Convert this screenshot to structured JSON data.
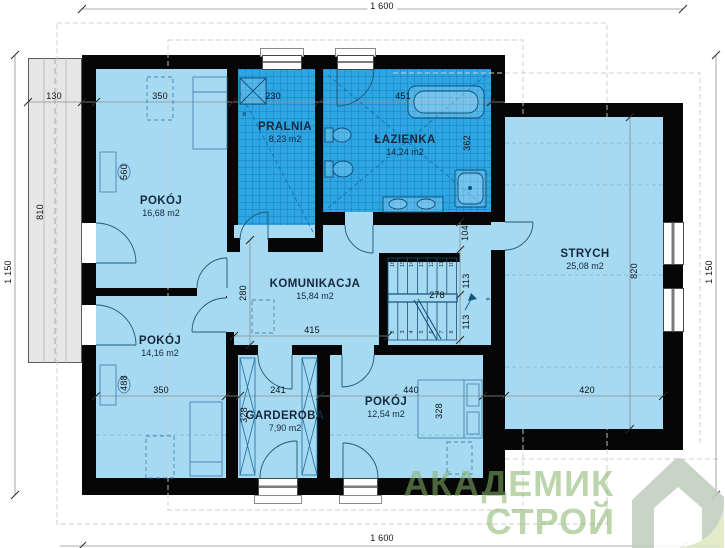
{
  "plan": {
    "title_note": "attic floor plan",
    "rooms": {
      "pokoj1": {
        "name": "POKÓJ",
        "area": "16,68 m2"
      },
      "pralnia": {
        "name": "PRALNIA",
        "area": "8,23 m2"
      },
      "lazienka": {
        "name": "ŁAZIENKA",
        "area": "14,24 m2"
      },
      "strych": {
        "name": "STRYCH",
        "area": "25,08 m2"
      },
      "komunikacja": {
        "name": "KOMUNIKACJA",
        "area": "15,84 m2"
      },
      "pokoj2": {
        "name": "POKÓJ",
        "area": "14,16 m2"
      },
      "garderoba": {
        "name": "GARDEROBA",
        "area": "7,90 m2"
      },
      "pokoj3": {
        "name": "POKÓJ",
        "area": "12,54 m2"
      }
    },
    "dimensions": {
      "overall_top": "1 600",
      "overall_bottom": "1 600",
      "overall_left": "1 150",
      "overall_right": "1 150",
      "balcony_width": "130",
      "balcony_length": "810",
      "pokoj1_width": "350",
      "pokoj1_depth": "560",
      "pralnia_width": "230",
      "lazienka_width": "451",
      "lazienka_depth": "362",
      "strych_depth": "820",
      "strych_width": "420",
      "komunikacja_depth": "280",
      "komunikacja_width": "415",
      "strych_door_width": "104",
      "stairs_width": "278",
      "stairs_run_upper": "113",
      "stairs_run_lower": "113",
      "pokoj2_depth": "488",
      "pokoj2_width": "350",
      "garderoba_width": "241",
      "garderoba_depth": "328",
      "pokoj3_width": "440",
      "pokoj3_depth": "328"
    },
    "stairs": {
      "top_treads": [
        "16",
        "15",
        "14",
        "13",
        "12",
        "11",
        "10"
      ],
      "bottom_treads": [
        "2",
        "3",
        "4",
        "5",
        "6",
        "7",
        "8"
      ],
      "winder": "9"
    },
    "washer_label": "w",
    "watermark": {
      "line1": "АКАДЕМИК",
      "line2": "СТРОЙ"
    },
    "colors": {
      "wall": "#060606",
      "room_fill": "#a6d9f2",
      "wet_room_fill": "#2ea6e4",
      "balcony_fill": "#e6e6e6",
      "watermark_green": "#85b26a",
      "logo_house": "#c3d0bf",
      "logo_fold": "#e0e9c6"
    }
  }
}
